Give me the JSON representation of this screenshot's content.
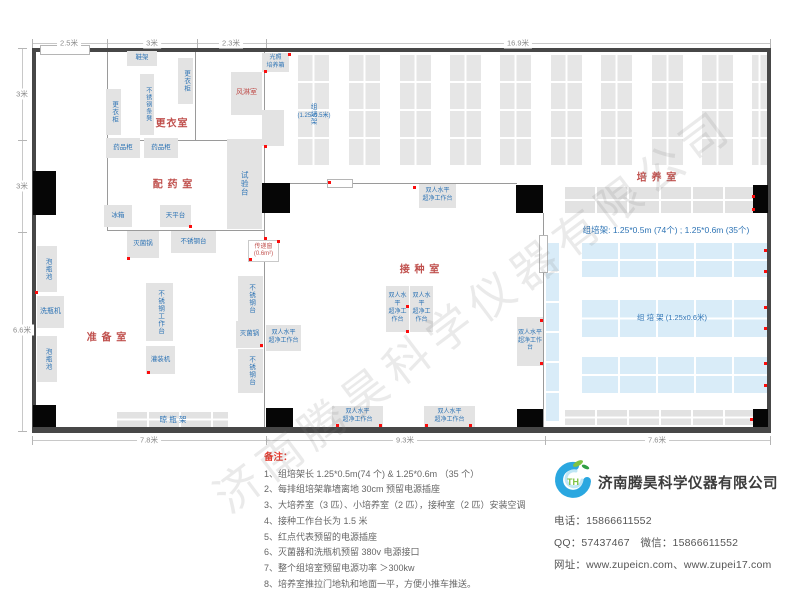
{
  "watermark": "济南腾昊科学仪器有限公司",
  "dims": {
    "top": {
      "line": [
        32,
        43,
        739
      ],
      "ticks": [
        32,
        107,
        197,
        266,
        770
      ],
      "labels": [
        {
          "t": "2.5米",
          "x": 69
        },
        {
          "t": "3米",
          "x": 152
        },
        {
          "t": "2.3米",
          "x": 231
        },
        {
          "t": "16.9米",
          "x": 518
        }
      ]
    },
    "left": {
      "line": [
        22,
        48,
        384
      ],
      "ticks": [
        48,
        140,
        232,
        431
      ],
      "labels": [
        {
          "t": "3米",
          "y": 94
        },
        {
          "t": "3米",
          "y": 186
        },
        {
          "t": "6.6米",
          "y": 330
        }
      ]
    },
    "bottom": {
      "line": [
        32,
        440,
        739
      ],
      "ticks": [
        32,
        266,
        545,
        770
      ],
      "labels": [
        {
          "t": "7.8米",
          "x": 149
        },
        {
          "t": "9.3米",
          "x": 405
        },
        {
          "t": "7.6米",
          "x": 657
        }
      ]
    }
  },
  "floorplan": {
    "bench_label": "双人水平\n超净工作台",
    "walls": [
      [
        32,
        48,
        739,
        4,
        1
      ],
      [
        32,
        48,
        4,
        384,
        1
      ],
      [
        767,
        48,
        4,
        384,
        1
      ],
      [
        32,
        427,
        739,
        6,
        1
      ],
      [
        107,
        52,
        1,
        179,
        0
      ],
      [
        195,
        52,
        1,
        89,
        0
      ],
      [
        107,
        140,
        158,
        1,
        0
      ],
      [
        107,
        230,
        158,
        1,
        0
      ],
      [
        264,
        52,
        1,
        375,
        0
      ],
      [
        290,
        183,
        227,
        1,
        0
      ],
      [
        543,
        213,
        1,
        214,
        0
      ]
    ],
    "doors": [
      [
        40,
        45,
        50,
        10
      ],
      [
        327,
        179,
        26,
        9
      ],
      [
        539,
        235,
        9,
        38
      ]
    ],
    "pillars": [
      [
        33,
        171,
        23,
        44
      ],
      [
        262,
        183,
        28,
        30
      ],
      [
        516,
        185,
        27,
        28
      ],
      [
        753,
        185,
        15,
        28
      ],
      [
        33,
        405,
        23,
        22
      ],
      [
        266,
        408,
        27,
        19
      ],
      [
        517,
        409,
        26,
        18
      ],
      [
        753,
        409,
        15,
        18
      ]
    ],
    "racks_v": {
      "y": 55,
      "h": 112,
      "items": [
        [
          298,
          31
        ],
        [
          349,
          31
        ],
        [
          400,
          31
        ],
        [
          450,
          31
        ],
        [
          500,
          31
        ],
        [
          551,
          31
        ],
        [
          601,
          31
        ],
        [
          652,
          31
        ],
        [
          702,
          31
        ],
        [
          752,
          15
        ]
      ]
    },
    "racks_h": [
      [
        565,
        187,
        188,
        26
      ],
      [
        565,
        410,
        188,
        15
      ],
      [
        117,
        412,
        111,
        15
      ]
    ],
    "racks_blue": [
      [
        546,
        243,
        13,
        180,
        "v"
      ],
      [
        582,
        243,
        186,
        34
      ],
      [
        582,
        300,
        186,
        37
      ],
      [
        582,
        357,
        186,
        36
      ]
    ],
    "equipment": [
      {
        "n": "shoe-rack",
        "t": "鞋架",
        "x": 127,
        "y": 51,
        "w": 30,
        "h": 15
      },
      {
        "n": "locker-cabinet",
        "t": "更衣柜",
        "x": 178,
        "y": 58,
        "w": 15,
        "h": 46,
        "v": 1
      },
      {
        "n": "stainless-bench",
        "t": "不锈钢条凳",
        "x": 140,
        "y": 74,
        "w": 14,
        "h": 61,
        "v": 1,
        "fs": 6
      },
      {
        "n": "locker-cabinet",
        "t": "更衣柜",
        "x": 106,
        "y": 89,
        "w": 15,
        "h": 46,
        "v": 1
      },
      {
        "n": "air-shower-room",
        "t": "风淋室",
        "x": 231,
        "y": 72,
        "w": 31,
        "h": 43,
        "red": 1,
        "fs": 7
      },
      {
        "n": "light-incubator",
        "t": "光照\n培养箱",
        "x": 262,
        "y": 53,
        "w": 27,
        "h": 19,
        "fs": 6
      },
      {
        "n": "shelf",
        "t": "",
        "x": 262,
        "y": 110,
        "w": 22,
        "h": 36
      },
      {
        "n": "medicine-cabinet",
        "t": "药品柜",
        "x": 106,
        "y": 138,
        "w": 34,
        "h": 20
      },
      {
        "n": "medicine-cabinet",
        "t": "药品柜",
        "x": 144,
        "y": 138,
        "w": 34,
        "h": 20
      },
      {
        "n": "test-bench",
        "t": "试验台",
        "x": 227,
        "y": 139,
        "w": 35,
        "h": 90,
        "v": 1,
        "fs": 7.5
      },
      {
        "n": "refrigerator",
        "t": "冰箱",
        "x": 104,
        "y": 205,
        "w": 28,
        "h": 22
      },
      {
        "n": "balance-table",
        "t": "天平台",
        "x": 160,
        "y": 205,
        "w": 31,
        "h": 22
      },
      {
        "n": "sterilizer",
        "t": "灭菌锅",
        "x": 127,
        "y": 231,
        "w": 32,
        "h": 27
      },
      {
        "n": "stainless-table",
        "t": "不锈钢台",
        "x": 171,
        "y": 231,
        "w": 45,
        "h": 22
      },
      {
        "n": "bottle-soaking-pool",
        "t": "泡瓶池",
        "x": 37,
        "y": 246,
        "w": 20,
        "h": 46,
        "v": 1
      },
      {
        "n": "bottle-washer",
        "t": "洗瓶机",
        "x": 37,
        "y": 296,
        "w": 27,
        "h": 32,
        "fs": 7
      },
      {
        "n": "bottle-soaking-pool",
        "t": "泡瓶池",
        "x": 37,
        "y": 336,
        "w": 20,
        "h": 46,
        "v": 1
      },
      {
        "n": "stainless-worktable",
        "t": "不锈钢工作台",
        "x": 146,
        "y": 283,
        "w": 27,
        "h": 58,
        "v": 1
      },
      {
        "n": "filling-machine",
        "t": "灌装机",
        "x": 146,
        "y": 346,
        "w": 29,
        "h": 28
      },
      {
        "n": "stainless-table",
        "t": "不锈钢台",
        "x": 238,
        "y": 276,
        "w": 25,
        "h": 46,
        "v": 1
      },
      {
        "n": "sterilizer",
        "t": "灭菌锅",
        "x": 236,
        "y": 321,
        "w": 27,
        "h": 27
      },
      {
        "n": "stainless-table",
        "t": "不锈钢台",
        "x": 238,
        "y": 349,
        "w": 25,
        "h": 44,
        "v": 1
      },
      {
        "n": "pass-through-window",
        "t": "传递窗\n(0.6m²)",
        "x": 248,
        "y": 240,
        "w": 31,
        "h": 22,
        "white": 1
      },
      {
        "n": "rack-label",
        "t": "组培架",
        "x": 305,
        "y": 92,
        "w": 14,
        "h": 44,
        "v": 1,
        "bare": 1
      },
      {
        "n": "rack-label",
        "t": "(1.25x0.5米)",
        "x": 288,
        "y": 112,
        "w": 52,
        "h": 10,
        "bare": 1,
        "fs": 6
      },
      {
        "n": "rack-label",
        "t": "组  培  架 (1.25x0.6米)",
        "x": 602,
        "y": 312,
        "w": 140,
        "h": 12,
        "bare": 1,
        "fs": 7.5
      },
      {
        "n": "rack-summary-label",
        "t": "组培架: 1.25*0.5m (74个) ; 1.25*0.6m (35个)",
        "x": 575,
        "y": 224,
        "w": 182,
        "h": 13,
        "bare": 1,
        "fs": 8.5
      },
      {
        "n": "bottle-drying-rack-label",
        "t": "晾  瓶  架",
        "x": 130,
        "y": 414,
        "w": 86,
        "h": 11,
        "bare": 1,
        "fs": 7.5
      }
    ],
    "benches": [
      [
        419,
        184,
        37,
        24
      ],
      [
        266,
        325,
        35,
        26
      ],
      [
        386,
        286,
        23,
        46
      ],
      [
        410,
        286,
        23,
        46
      ],
      [
        517,
        317,
        26,
        49
      ],
      [
        332,
        406,
        51,
        21
      ],
      [
        424,
        406,
        51,
        21
      ]
    ],
    "room_labels": [
      {
        "t": "更衣室",
        "x": 172,
        "y": 122
      },
      {
        "t": "配 药 室",
        "x": 173,
        "y": 183
      },
      {
        "t": "准 备 室",
        "x": 107,
        "y": 336
      },
      {
        "t": "接 种 室",
        "x": 420,
        "y": 268
      },
      {
        "t": "培 养 室",
        "x": 657,
        "y": 176
      }
    ],
    "outlets": [
      [
        288,
        53
      ],
      [
        264,
        70
      ],
      [
        264,
        145
      ],
      [
        264,
        237
      ],
      [
        249,
        258
      ],
      [
        277,
        240
      ],
      [
        127,
        257
      ],
      [
        189,
        225
      ],
      [
        35,
        291
      ],
      [
        147,
        371
      ],
      [
        260,
        344
      ],
      [
        328,
        181
      ],
      [
        413,
        186
      ],
      [
        406,
        305
      ],
      [
        406,
        330
      ],
      [
        540,
        319
      ],
      [
        540,
        362
      ],
      [
        336,
        424
      ],
      [
        379,
        424
      ],
      [
        425,
        424
      ],
      [
        469,
        424
      ],
      [
        764,
        249
      ],
      [
        764,
        270
      ],
      [
        764,
        306
      ],
      [
        764,
        327
      ],
      [
        764,
        362
      ],
      [
        764,
        384
      ],
      [
        750,
        418
      ],
      [
        752,
        195
      ],
      [
        752,
        208
      ]
    ]
  },
  "notes": {
    "title": "备注：",
    "items": [
      "1、组培架长 1.25*0.5m(74 个) & 1.25*0.6m （35 个）",
      "2、每排组培架靠墙离地 30cm 预留电源插座",
      "3、大培养室（3 匹）、小培养室（2 匹），接种室（2 匹）安装空调",
      "4、接种工作台长为 1.5 米",
      "5、红点代表预留的电源插座",
      "6、灭菌器和洗瓶机预留 380v 电源接口",
      "7、整个组培室预留电源功率 ＞300kw",
      "8、培养室推拉门地轨和地面一平，方便小推车推送。"
    ]
  },
  "company": {
    "name": "济南腾昊科学仪器有限公司",
    "lines": [
      "电话：15866611552",
      "QQ：57437467　微信：15866611552",
      "网址：www.zupeicn.com、www.zupei17.com"
    ]
  }
}
